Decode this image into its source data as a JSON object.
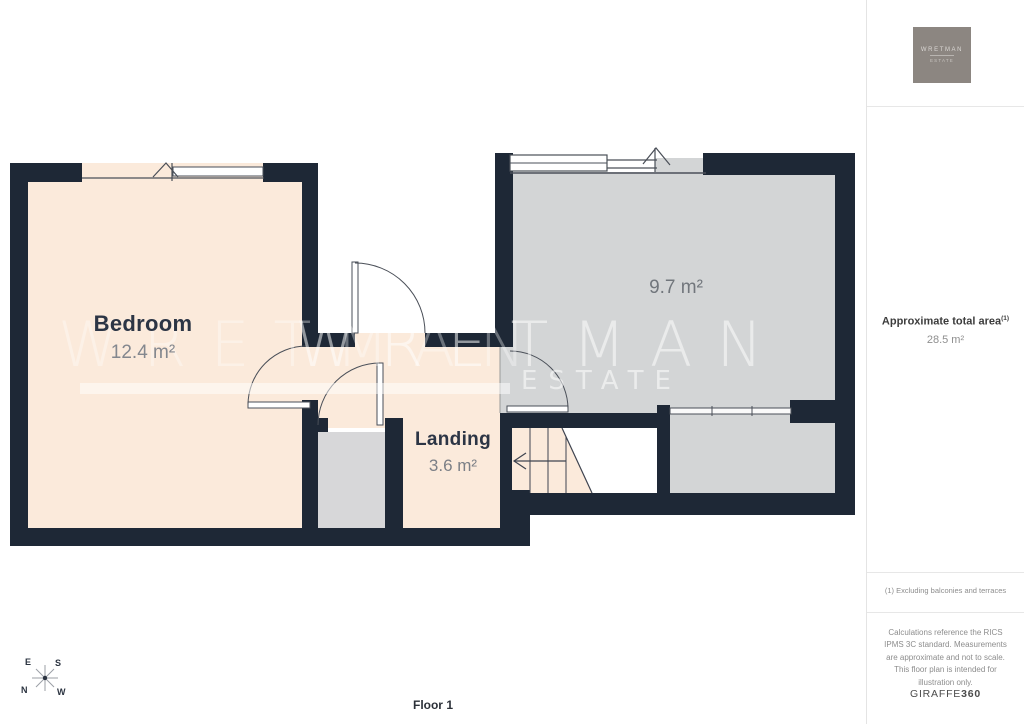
{
  "floor_plan": {
    "floor_label": "Floor 1",
    "rooms": {
      "bedroom": {
        "name": "Bedroom",
        "area": "12.4 m²"
      },
      "landing": {
        "name": "Landing",
        "area": "3.6 m²"
      },
      "room2": {
        "area": "9.7 m²"
      }
    },
    "compass": {
      "e": "E",
      "s": "S",
      "n": "N",
      "w": "W"
    },
    "watermark": {
      "name": "WRETMAN",
      "suffix": "ESTATE"
    },
    "colors": {
      "wall": "#1e2836",
      "room_warm": "#fbeadb",
      "room_cool": "#d3d5d6",
      "line": "#4a4f58"
    }
  },
  "sidebar": {
    "logo": {
      "name": "WRETMAN",
      "suffix": "ESTATE"
    },
    "total_area": {
      "label": "Approximate total area",
      "superscript": "(1)",
      "value": "28.5 m²"
    },
    "footnote": "(1) Excluding balconies and terraces",
    "disclaimer": "Calculations reference the RICS IPMS 3C standard. Measurements are approximate and not to scale. This floor plan is intended for illustration only.",
    "brand": {
      "name": "GIRAFFE",
      "suffix": "360"
    }
  }
}
